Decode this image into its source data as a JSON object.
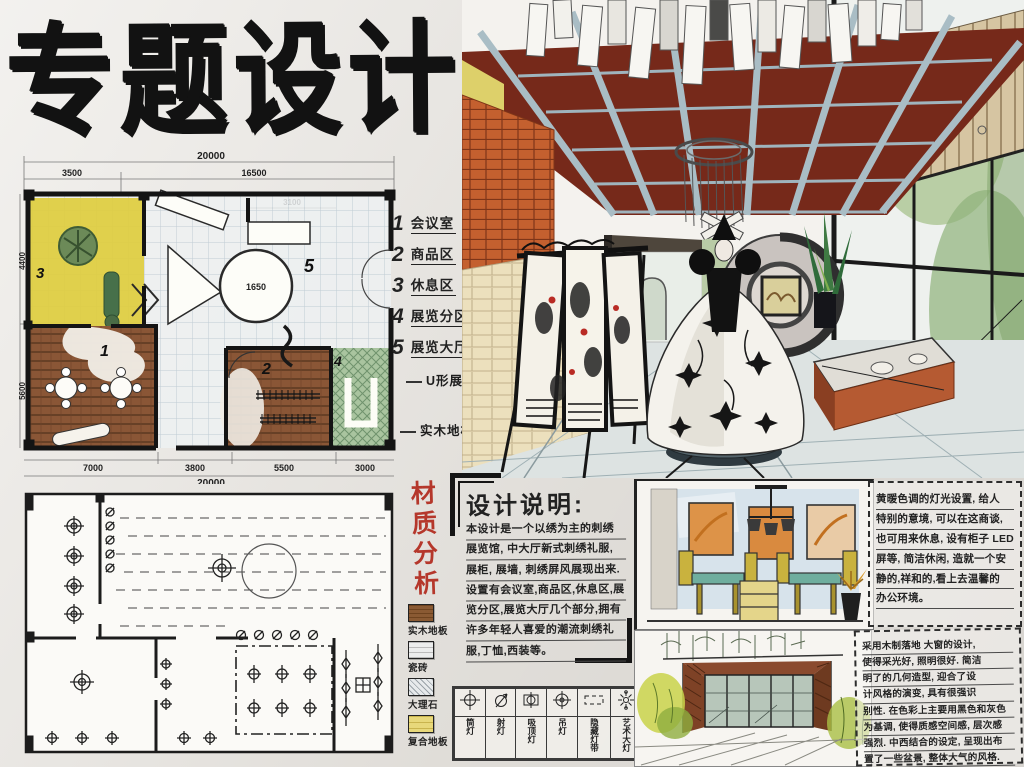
{
  "title": {
    "text": "专题设计"
  },
  "floor_plan": {
    "dims": {
      "top_total": "20000",
      "top_left": "3500",
      "top_right": "16500",
      "inner_top": "3100",
      "left_upper": "4400",
      "left_lower": "5600",
      "bottom_1": "7000",
      "bottom_2": "3800",
      "bottom_3": "5500",
      "bottom_4": "3000",
      "bottom_total": "20000",
      "hall_circle": "1650"
    },
    "rooms": [
      {
        "num": "1"
      },
      {
        "num": "2"
      },
      {
        "num": "3"
      },
      {
        "num": "4"
      },
      {
        "num": "5"
      }
    ],
    "annotations": [
      {
        "label": "U形展隔"
      },
      {
        "label": "实木地板"
      }
    ]
  },
  "room_key": {
    "items": [
      {
        "num": "1",
        "label": "会议室"
      },
      {
        "num": "2",
        "label": "商品区"
      },
      {
        "num": "3",
        "label": "休息区"
      },
      {
        "num": "4",
        "label": "展览分区"
      },
      {
        "num": "5",
        "label": "展览大厅"
      }
    ]
  },
  "materials": {
    "title": "材质分析",
    "accent_color": "#b5372b",
    "items": [
      {
        "label": "实木地板",
        "color": "#8a5a33"
      },
      {
        "label": "瓷砖",
        "color": "#eceded"
      },
      {
        "label": "大理石",
        "color": "#dfe3e6"
      },
      {
        "label": "复合地板",
        "color": "#e8d87a"
      }
    ]
  },
  "design_notes": {
    "title": "设计说明:",
    "lines": [
      "本设计是一个以绣为主的刺绣",
      "展览馆, 中大厅新式刺绣礼服,",
      "展柜, 展墙, 刺绣屏风展现出来.",
      "设置有会议室,商品区,休息区,展",
      "览分区,展览大厅几个部分,拥有",
      "许多年轻人喜爱的潮流刺绣礼",
      "服,丁恤,西装等。"
    ]
  },
  "lamp_legend": {
    "items": [
      {
        "icon": "downlight-icon",
        "label": "筒灯"
      },
      {
        "icon": "spotlight-icon",
        "label": "射灯"
      },
      {
        "icon": "ceiling-lamp-icon",
        "label": "吸顶灯"
      },
      {
        "icon": "pendant-lamp-icon",
        "label": "吊灯"
      },
      {
        "icon": "hidden-strip-icon",
        "label": "隐藏灯带"
      },
      {
        "icon": "art-chandelier-icon",
        "label": "艺术大灯"
      }
    ]
  },
  "note_top_right": {
    "lines": [
      "黄暖色调的灯光设置, 给人",
      "特别的意境, 可以在这商谈,",
      "也可用来休息, 设有柜子 LED",
      "屏等, 简洁休闲, 造就一个安",
      "静的,祥和的,看上去温馨的",
      "办公环境。"
    ]
  },
  "note_bottom_right": {
    "lines": [
      "采用木制落地 大窗的设计,",
      "使得采光好, 照明很好. 简洁",
      "明了的几何造型, 迎合了设",
      "计风格的演变, 具有很强识",
      "别性. 在色彩上主要用黑色和灰色",
      "为基调, 使得质感空间感, 层次感",
      "强烈. 中西结合的设定, 呈现出布",
      "置了一些盆景, 整体大气的风格."
    ]
  }
}
